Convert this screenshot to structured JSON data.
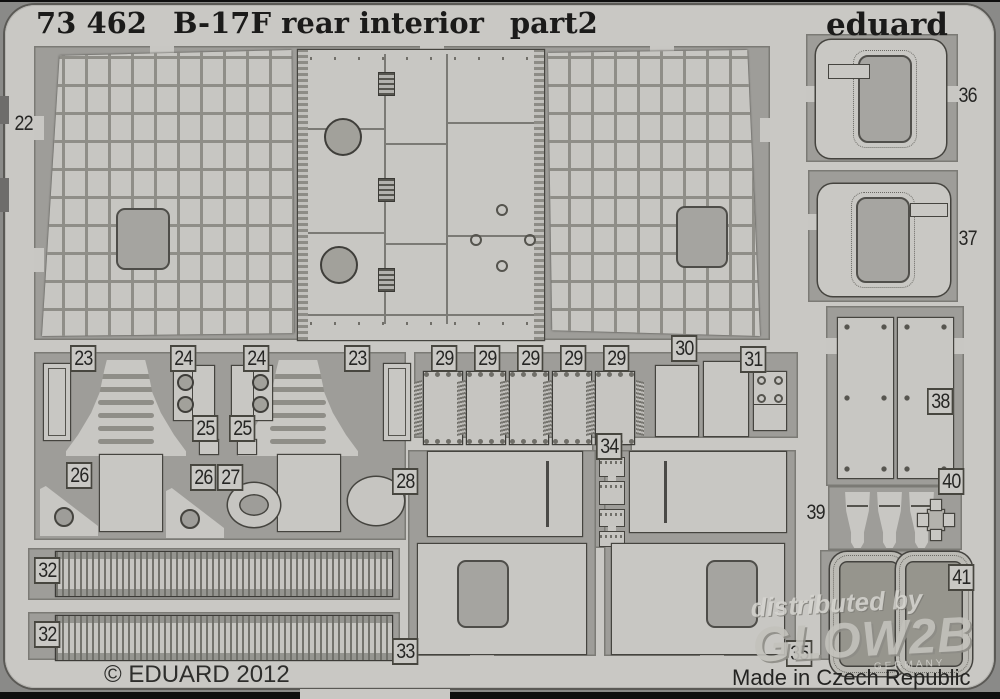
{
  "header": {
    "catalog_number": "73 462",
    "title": "B-17F rear interior",
    "part_suffix": "part2",
    "brand": "eduard"
  },
  "footer": {
    "copyright": "© EDUARD 2012",
    "origin": "Made in Czech Republic"
  },
  "watermark": {
    "prefix": "distributed by",
    "brand": "GLOW2B",
    "sub": "GERMANY"
  },
  "colors": {
    "sheet_light": "#c9c8c4",
    "etched_recess": "#9e9d99",
    "dark_fill": "#a5a4a0",
    "outline": "#45443f",
    "ink": "#1b1b1a",
    "photo_margin": "#8a8a88"
  },
  "sheet": {
    "description": "photo-etched fret with numbered parts",
    "labels": [
      {
        "n": "22",
        "x": 12,
        "y": 112,
        "style": "plain"
      },
      {
        "n": "23",
        "x": 70,
        "y": 345,
        "style": "tab"
      },
      {
        "n": "24",
        "x": 170,
        "y": 345,
        "style": "tab"
      },
      {
        "n": "24",
        "x": 243,
        "y": 345,
        "style": "tab"
      },
      {
        "n": "23",
        "x": 344,
        "y": 345,
        "style": "tab"
      },
      {
        "n": "25",
        "x": 192,
        "y": 415,
        "style": "tab"
      },
      {
        "n": "25",
        "x": 229,
        "y": 415,
        "style": "tab"
      },
      {
        "n": "26",
        "x": 66,
        "y": 462,
        "style": "tab"
      },
      {
        "n": "26",
        "x": 190,
        "y": 464,
        "style": "tab"
      },
      {
        "n": "27",
        "x": 217,
        "y": 464,
        "style": "tab"
      },
      {
        "n": "28",
        "x": 392,
        "y": 468,
        "style": "tab"
      },
      {
        "n": "29",
        "x": 431,
        "y": 345,
        "style": "tab"
      },
      {
        "n": "29",
        "x": 474,
        "y": 345,
        "style": "tab"
      },
      {
        "n": "29",
        "x": 517,
        "y": 345,
        "style": "tab"
      },
      {
        "n": "29",
        "x": 560,
        "y": 345,
        "style": "tab"
      },
      {
        "n": "29",
        "x": 603,
        "y": 345,
        "style": "tab"
      },
      {
        "n": "30",
        "x": 671,
        "y": 335,
        "style": "tab"
      },
      {
        "n": "31",
        "x": 740,
        "y": 346,
        "style": "tab"
      },
      {
        "n": "32",
        "x": 34,
        "y": 557,
        "style": "tab"
      },
      {
        "n": "32",
        "x": 34,
        "y": 621,
        "style": "tab"
      },
      {
        "n": "33",
        "x": 392,
        "y": 638,
        "style": "tab"
      },
      {
        "n": "34",
        "x": 596,
        "y": 433,
        "style": "tab"
      },
      {
        "n": "35",
        "x": 786,
        "y": 640,
        "style": "tab"
      },
      {
        "n": "36",
        "x": 956,
        "y": 84,
        "style": "plain"
      },
      {
        "n": "37",
        "x": 956,
        "y": 227,
        "style": "plain"
      },
      {
        "n": "38",
        "x": 927,
        "y": 388,
        "style": "tab"
      },
      {
        "n": "39",
        "x": 804,
        "y": 501,
        "style": "plain"
      },
      {
        "n": "40",
        "x": 938,
        "y": 468,
        "style": "tab"
      },
      {
        "n": "41",
        "x": 948,
        "y": 564,
        "style": "tab"
      }
    ]
  }
}
